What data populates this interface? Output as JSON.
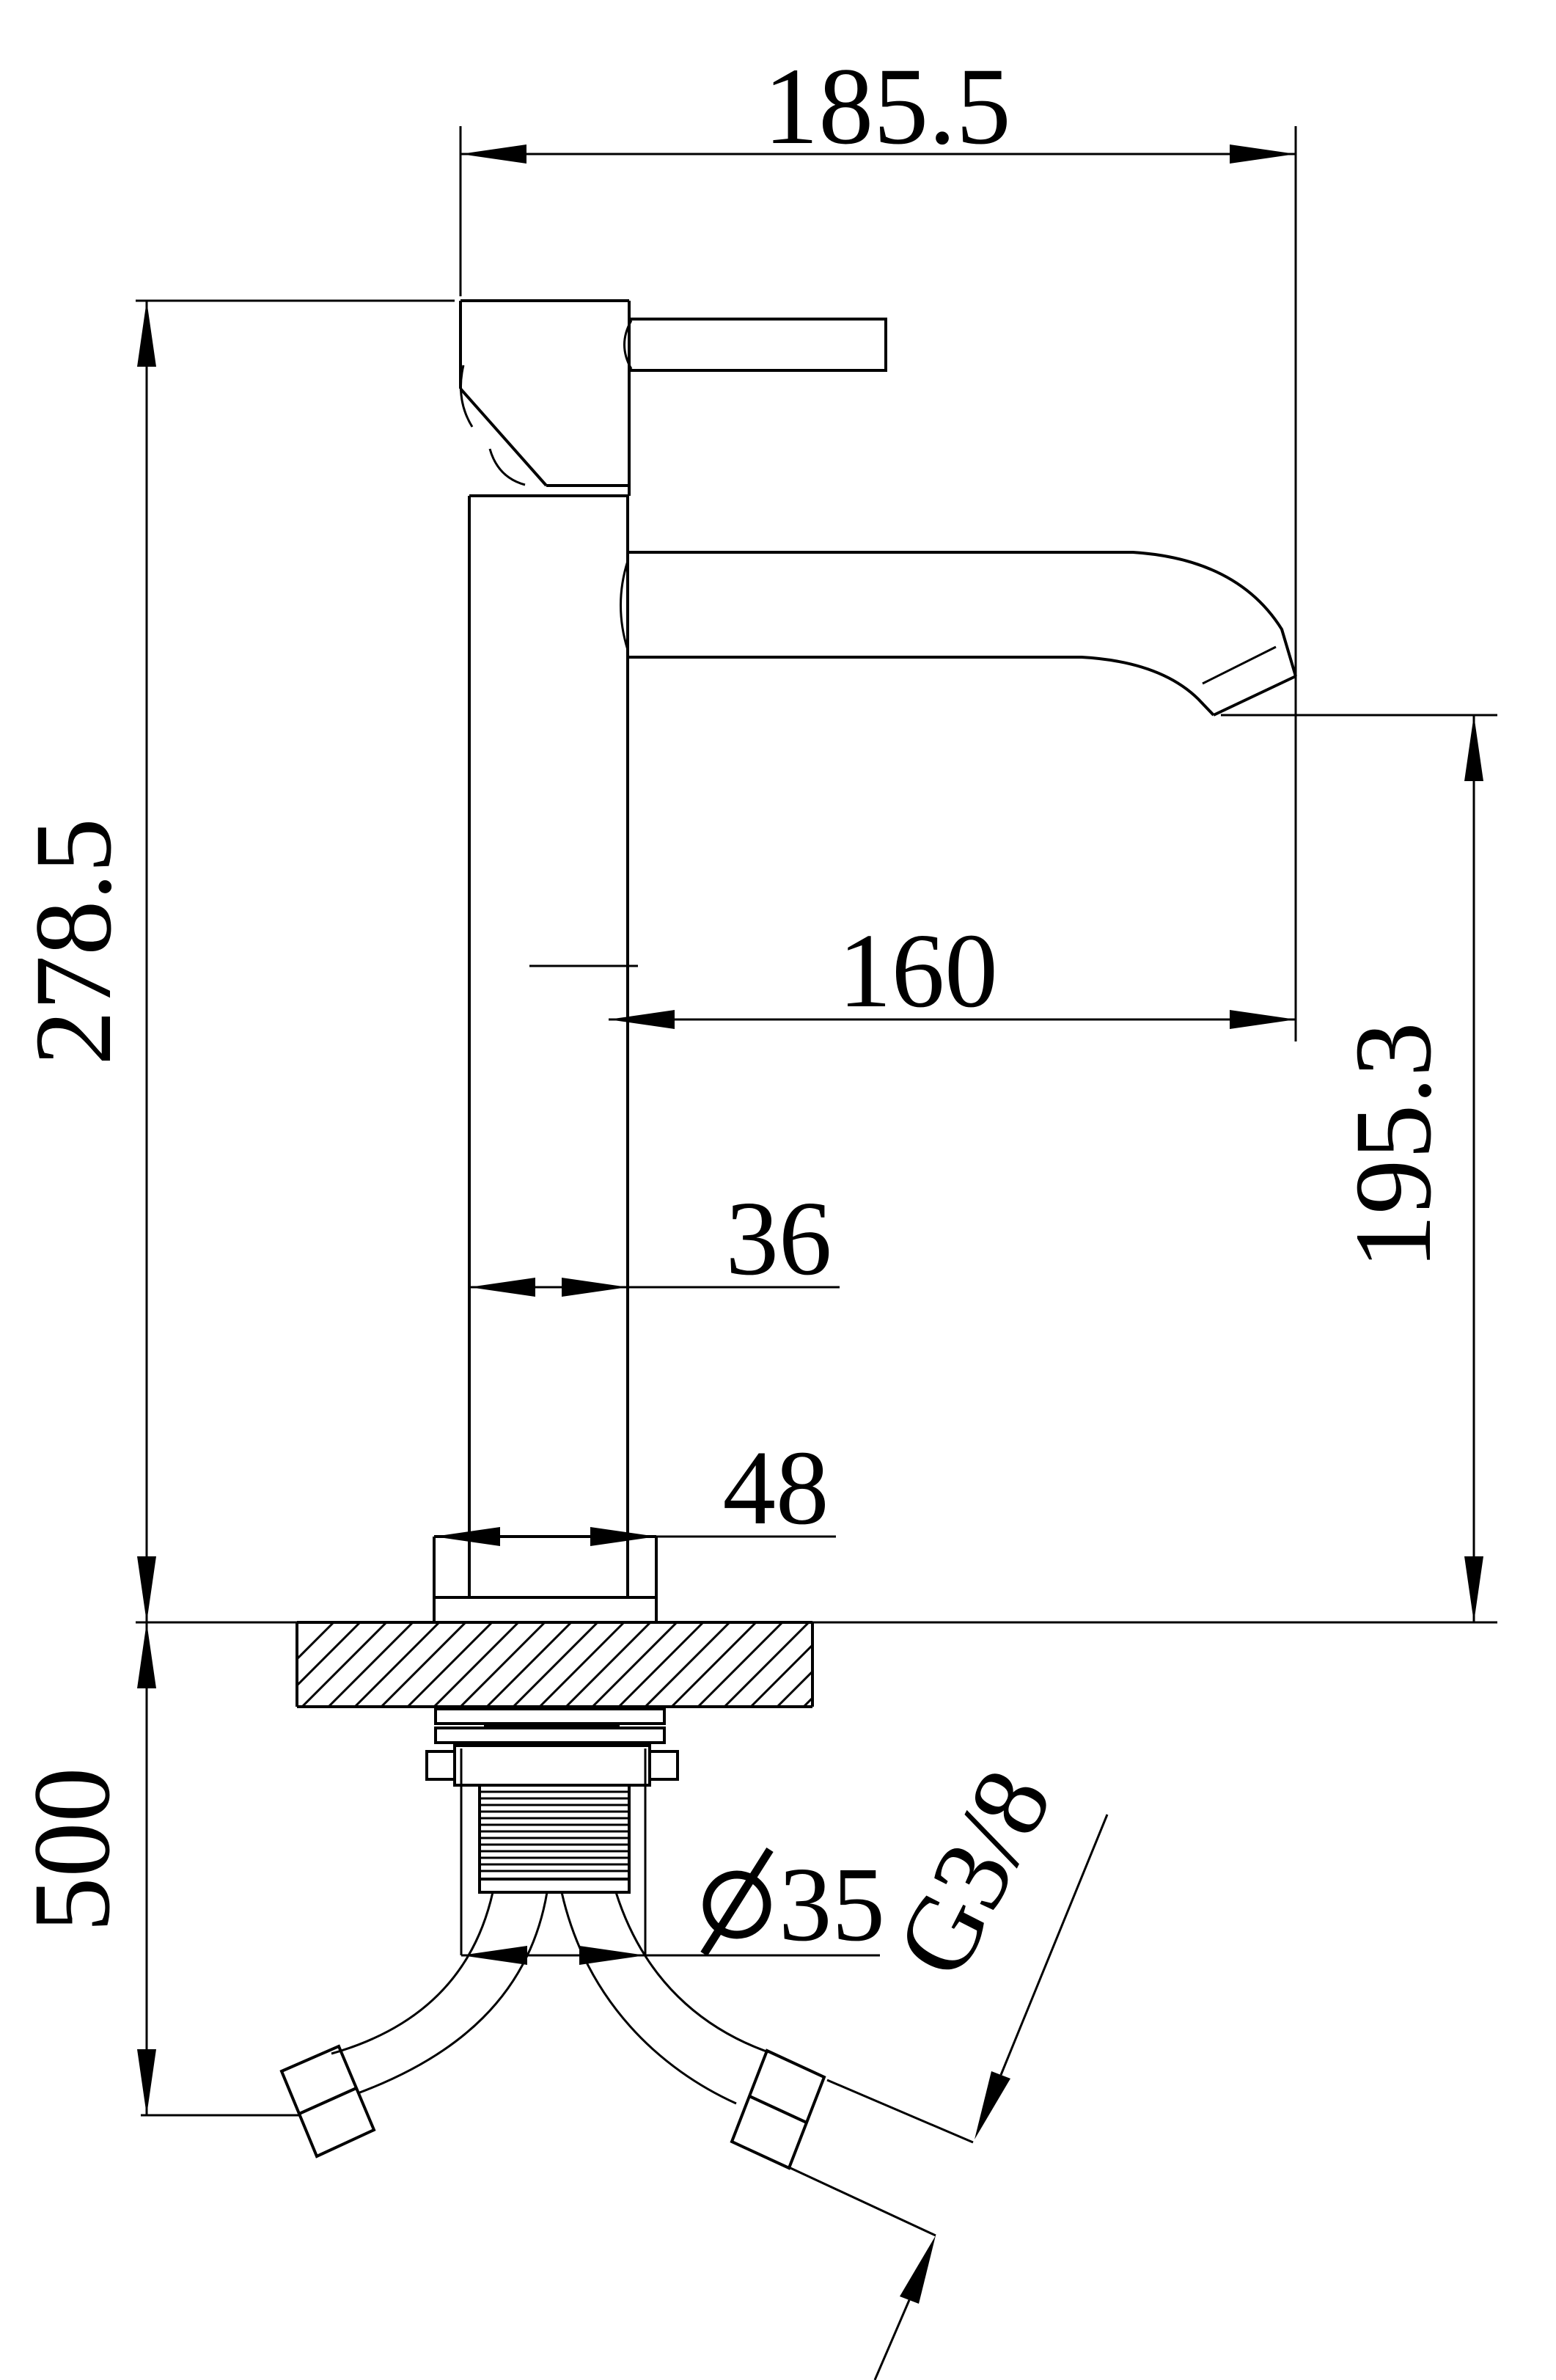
{
  "drawing": {
    "type": "technical-drawing",
    "subject": "single-lever basin faucet, front elevation with mounting section",
    "colors": {
      "line": "#000000",
      "background": "#ffffff"
    },
    "dimensions": {
      "overall_width": {
        "label": "185.5"
      },
      "overall_height": {
        "label": "278.5"
      },
      "spout_reach": {
        "label": "160"
      },
      "spout_height": {
        "label": "195.3"
      },
      "body_width": {
        "label": "36"
      },
      "base_width": {
        "label": "48"
      },
      "hose_length": {
        "label": "500"
      },
      "shank_diameter": {
        "label": "⌀35",
        "value": "35"
      },
      "thread_spec": {
        "label": "G3/8"
      }
    }
  }
}
